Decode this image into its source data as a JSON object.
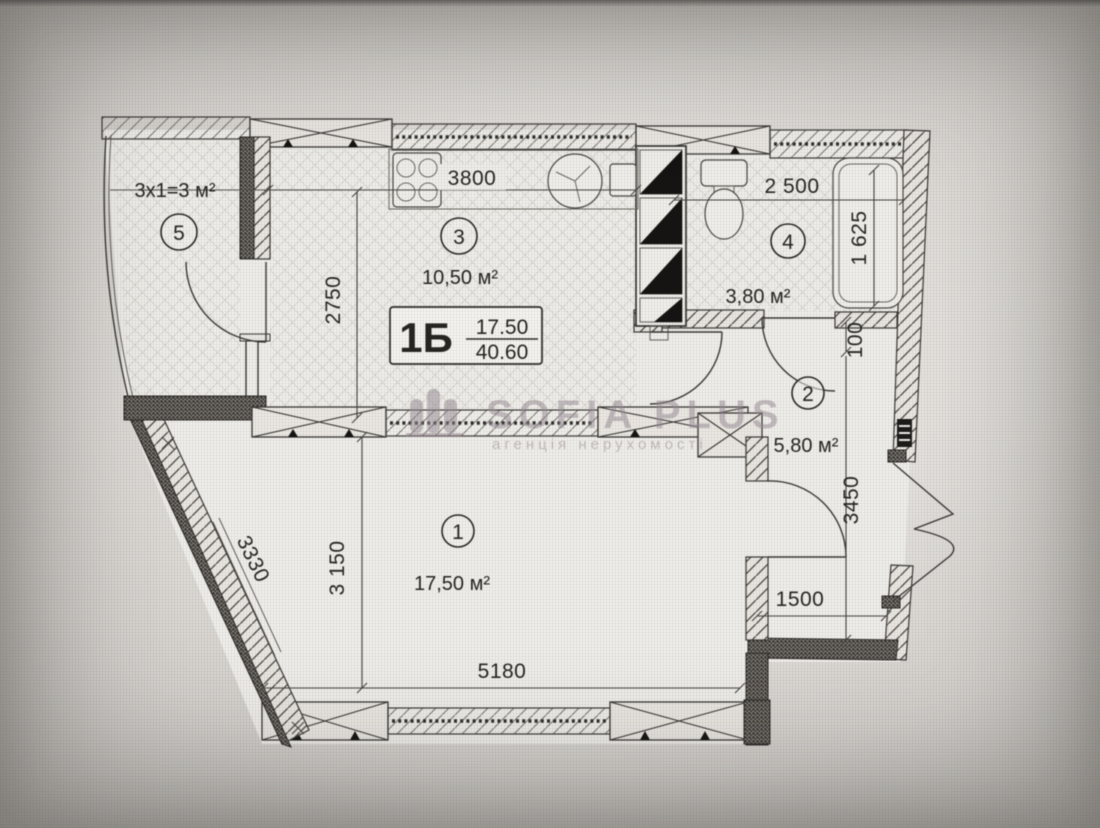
{
  "watermark": {
    "brand": "SOFIA PLUS",
    "tagline": "агенція нерухомості"
  },
  "unit": {
    "type_label": "1Б",
    "area_top": "17.50",
    "area_bottom": "40.60"
  },
  "rooms": {
    "balcony": {
      "number": "5",
      "area": "3x1=3 м²"
    },
    "kitchen": {
      "number": "3",
      "area": "10,50 м²"
    },
    "bathroom": {
      "number": "4",
      "area": "3,80 м²"
    },
    "hallway": {
      "number": "2",
      "area": "5,80 м²"
    },
    "living": {
      "number": "1",
      "area": "17,50 м²"
    }
  },
  "dimensions": {
    "kitchen_width": "3800",
    "bathroom_width": "2 500",
    "bathtub_length": "1 625",
    "kitchen_depth": "2750",
    "niche_depth": "100",
    "hallway_depth": "3450",
    "entry_recess_width": "1500",
    "living_width": "5180",
    "living_depth": "3 150",
    "living_slant_wall": "3330"
  }
}
